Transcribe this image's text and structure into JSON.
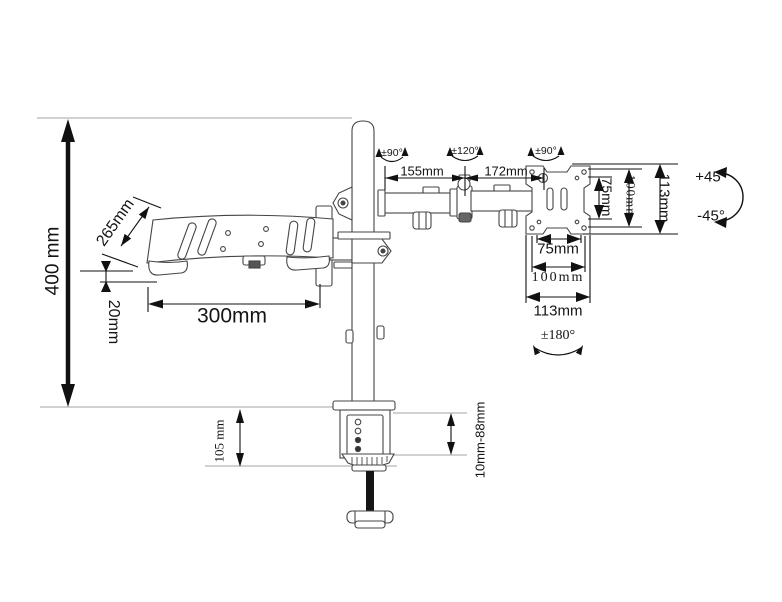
{
  "diagram_title": "Desk mount arm with laptop tray - dimension diagram",
  "labels": {
    "height_400": "400 mm",
    "tray_depth_265": "265mm",
    "tray_gap_20": "20mm",
    "tray_width_300": "300mm",
    "arm_seg1_155": "155mm",
    "arm_seg2_172": "172mm",
    "rot_pole": "±90°",
    "rot_mid": "±120°",
    "rot_head": "±90°",
    "vesa_v_75": "75mm",
    "vesa_v_100": "100mm",
    "vesa_v_113": "113mm",
    "tilt_up": "+45°",
    "tilt_down": "-45°",
    "vesa_h_75": "75mm",
    "vesa_h_100": "100mm",
    "vesa_h_113": "113mm",
    "rot_plate_180": "±180°",
    "clamp_height_105": "105 mm",
    "clamp_range": "10mm-88mm"
  },
  "dimensions": [
    {
      "part": "pole height above desk",
      "value": "400 mm"
    },
    {
      "part": "laptop tray depth",
      "value": "265mm"
    },
    {
      "part": "laptop tray plate thickness offset",
      "value": "20mm"
    },
    {
      "part": "laptop tray width",
      "value": "300mm"
    },
    {
      "part": "arm segment 1 length",
      "value": "155mm"
    },
    {
      "part": "arm segment 2 length",
      "value": "172mm"
    },
    {
      "part": "swivel at pole joint",
      "value": "±90°"
    },
    {
      "part": "swivel at elbow joint",
      "value": "±120°"
    },
    {
      "part": "swivel at head joint",
      "value": "±90°"
    },
    {
      "part": "VESA hole pattern vertical",
      "value": "75mm / 100mm"
    },
    {
      "part": "plate height",
      "value": "113mm"
    },
    {
      "part": "VESA hole pattern horizontal",
      "value": "75mm / 100mm"
    },
    {
      "part": "plate width",
      "value": "113mm"
    },
    {
      "part": "monitor tilt",
      "value": "+45° / -45°"
    },
    {
      "part": "plate rotation",
      "value": "±180°"
    },
    {
      "part": "clamp height",
      "value": "105 mm"
    },
    {
      "part": "desk thickness range",
      "value": "10mm-88mm"
    }
  ]
}
